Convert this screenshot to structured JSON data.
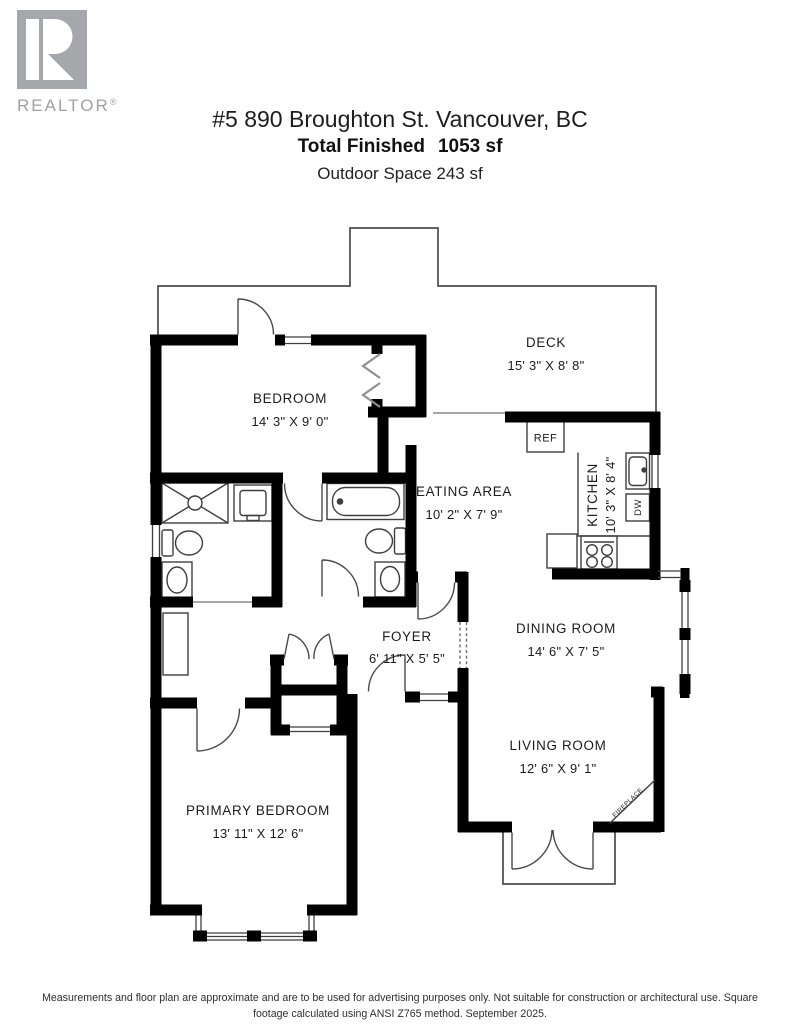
{
  "header": {
    "logo_brand": "REALTOR",
    "logo_registered": "®",
    "title": "#5 890 Broughton St. Vancouver, BC",
    "total_finished_label": "Total Finished",
    "total_finished_value": "1053 sf",
    "outdoor_space": "Outdoor Space 243 sf"
  },
  "rooms": {
    "bedroom": {
      "label": "BEDROOM",
      "dims": "14' 3\" X 9' 0\""
    },
    "deck": {
      "label": "DECK",
      "dims": "15' 3\" X 8' 8\""
    },
    "eating_area": {
      "label": "EATING AREA",
      "dims": "10' 2\" X 7' 9\""
    },
    "kitchen": {
      "label": "KITCHEN",
      "dims": "10' 3\" X 8' 4\""
    },
    "foyer": {
      "label": "FOYER",
      "dims": "6' 11\" X 5' 5\""
    },
    "dining_room": {
      "label": "DINING ROOM",
      "dims": "14' 6\" X 7' 5\""
    },
    "living_room": {
      "label": "LIVING ROOM",
      "dims": "12' 6\" X 9' 1\""
    },
    "primary_bedroom": {
      "label": "PRIMARY BEDROOM",
      "dims": "13' 11\" X 12' 6\""
    }
  },
  "fixtures": {
    "refrigerator": "REF",
    "dishwasher": "DW",
    "fireplace": "FIREPLACE"
  },
  "footer": {
    "line1": "Measurements and floor plan are approximate and are to be used for advertising purposes only. Not suitable for construction or architectural use. Square",
    "line2": "footage calculated using ANSI Z765 method. September 2025."
  },
  "colors": {
    "walls": "#000000",
    "thin_lines": "#3f3f3f",
    "deck_outline": "#4c4c4c",
    "logo_gray": "#a6a7aa",
    "text": "#1b1b1b"
  }
}
